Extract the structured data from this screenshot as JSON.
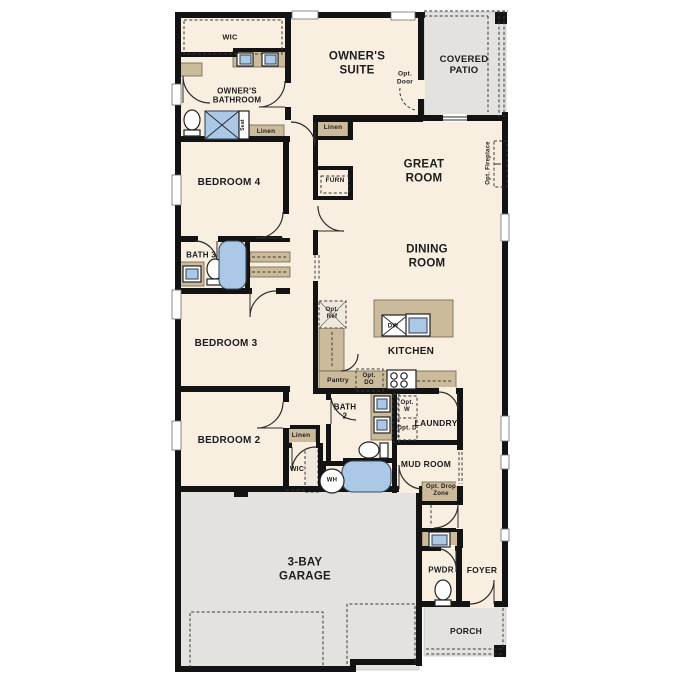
{
  "colors": {
    "background": "#ffffff",
    "floor": "#f8efe1",
    "wall": "#131313",
    "cabinet_tan": "#cbbb9b",
    "fixture_blue": "#abc9e7",
    "concrete_gray": "#e3e2df"
  },
  "rooms": {
    "wic": "WIC",
    "owners_bathroom": "OWNER'S BATHROOM",
    "owners_suite": "OWNER'S SUITE",
    "covered_patio": "COVERED PATIO",
    "great_room": "GREAT ROOM",
    "dining_room": "DINING ROOM",
    "kitchen": "KITCHEN",
    "bedroom4": "BEDROOM 4",
    "bedroom3": "BEDROOM 3",
    "bedroom2": "BEDROOM 2",
    "bath3": "BATH 3",
    "bath2": "BATH 2",
    "laundry": "LAUNDRY",
    "mud_room": "MUD ROOM",
    "wic2": "WIC",
    "pwdr": "PWDR",
    "foyer": "FOYER",
    "garage": "3-BAY GARAGE",
    "porch": "PORCH"
  },
  "features": {
    "linen_bath": "Linen",
    "linen_suite": "Linen",
    "linen_hall": "Linen",
    "seat": "Seat",
    "pantry": "Pantry",
    "furnace": "FURN",
    "dishwasher": "DW",
    "water_heater": "WH"
  },
  "options": {
    "opt_door": "Opt. Door",
    "opt_fireplace": "Opt. Fireplace",
    "opt_ref": "Opt. Ref",
    "opt_do": "Opt. DO",
    "opt_w": "Opt. W",
    "opt_d": "Opt. D",
    "opt_drop_zone": "Opt. Drop Zone"
  }
}
